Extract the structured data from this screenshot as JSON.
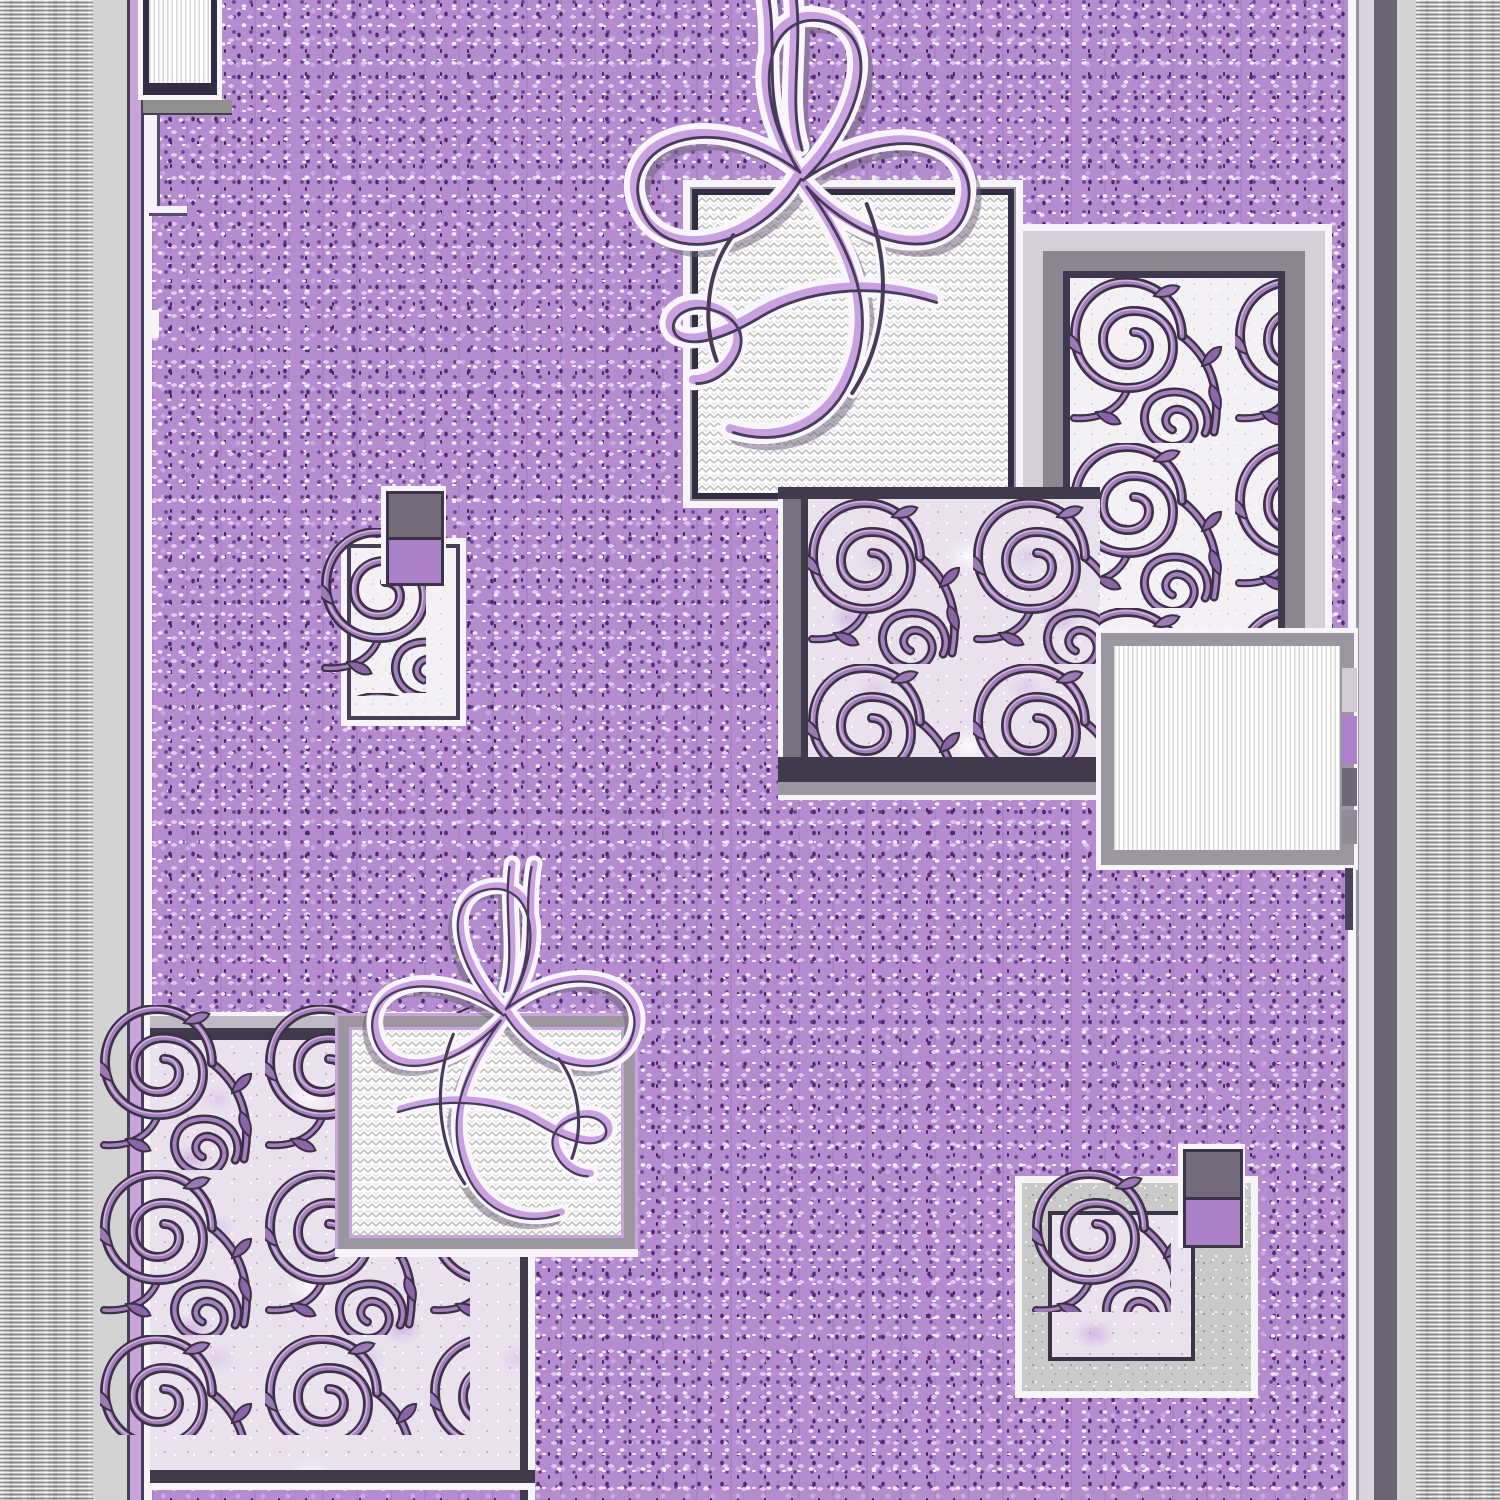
{
  "artwork": {
    "alt": "Lilac and grey carpet runner: speckled purple field, grey striped side borders, squares of scroll vine ornament, white wavy squares and calligraphic ribbon flourishes",
    "type": "textile-pattern-photo"
  },
  "palette": {
    "field_lilac": "#b48ccf",
    "field_speckle_dark": "#50296f",
    "field_speckle_light": "#f3eaf9",
    "border_gray": "#bdbdbd",
    "border_light_gray": "#d3d3d3",
    "border_dark_slate": "#6b6473",
    "frame_navy": "#332d44",
    "frame_gray": "#8f8f8f",
    "scroll_dark": "#3c3148",
    "scroll_mauve": "#a480bd",
    "scroll_highlight": "#d2b3e0",
    "ribbon_lavender": "#c9a1e0",
    "ribbon_outline": "#463c5a",
    "accent_square_gray": "#746b7a",
    "accent_square_purple": "#aa80c6",
    "panel_white": "#f7f4f8"
  },
  "regions": {
    "left_border": "grey horizontally striped border band",
    "right_border": "grey horizontally striped border band",
    "field": "speckled lilac pile field",
    "top_left_panel": "white pin-striped corner panel with navy frame",
    "top_wavy_square": "white chevron-wave square with navy frame",
    "top_flourish": "calligraphic ribbon bow flourish",
    "scroll_square_top_right": "vine scroll square, white ground",
    "scroll_square_middle": "vine scroll square, lilac ground",
    "striped_panel_right": "white pin-striped panel with grey frame",
    "small_scroll_square_left": "small vine scroll square",
    "accent_squares_left": "stacked grey and purple accent squares",
    "bottom_scroll_square": "large vine scroll square, lilac ground",
    "bottom_wavy_square": "white chevron-wave square with grey frame",
    "bottom_flourish": "mirrored calligraphic ribbon bow flourish",
    "scroll_square_bottom_right": "small vine scroll square, silver frame",
    "accent_squares_right": "stacked grey and purple accent squares"
  }
}
